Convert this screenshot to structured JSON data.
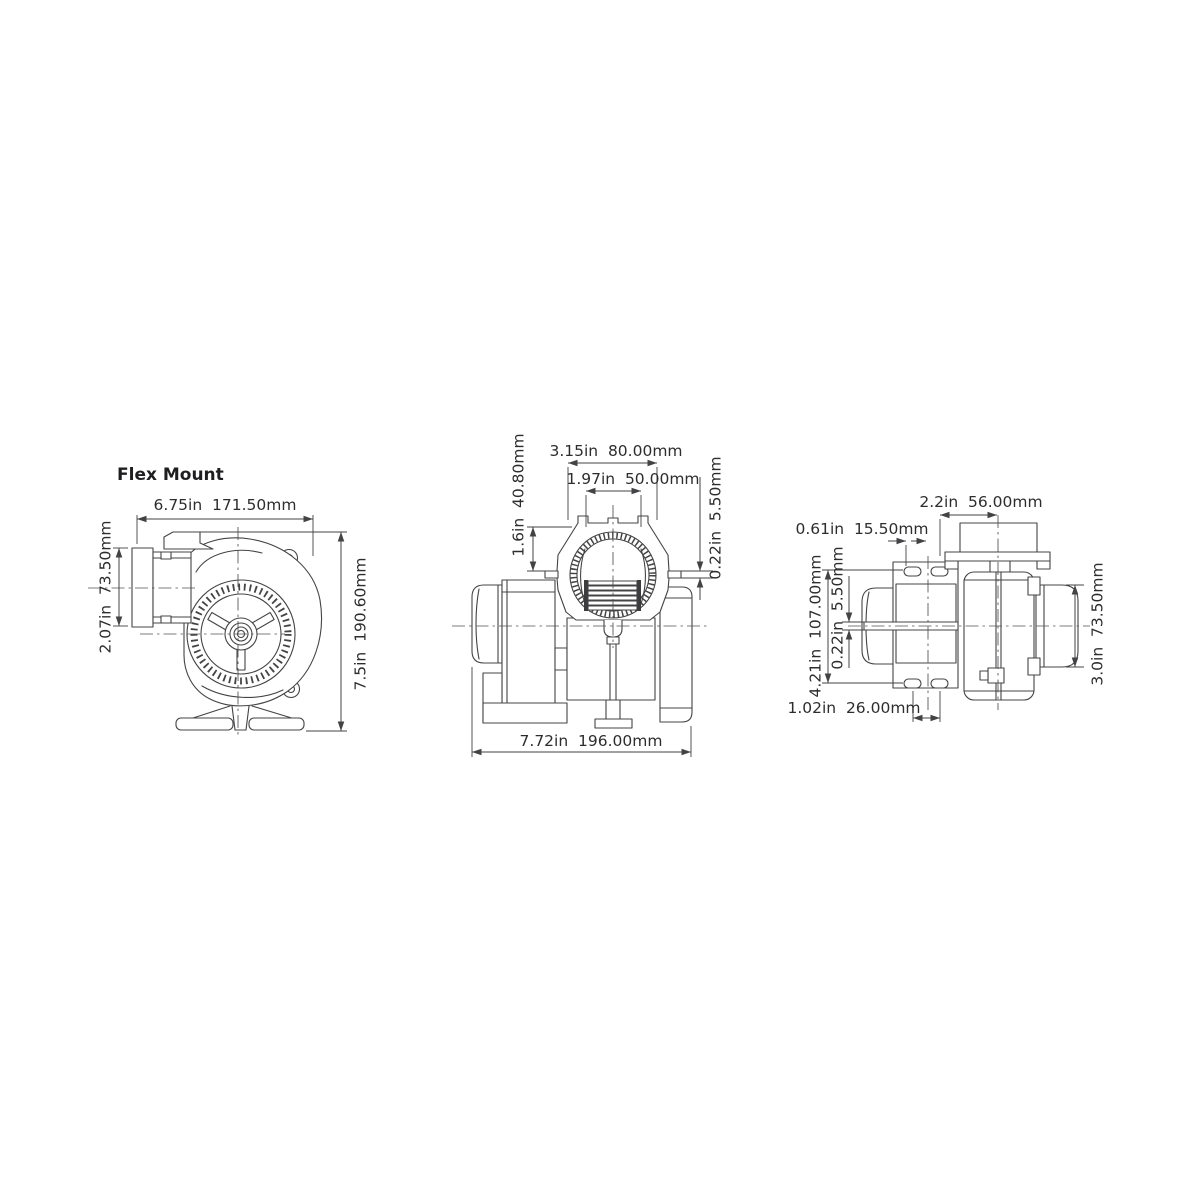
{
  "title": "Flex Mount",
  "colors": {
    "line": "#444446",
    "text": "#2d2d2f",
    "background": "#ffffff"
  },
  "side_view": {
    "width": "6.75in  171.50mm",
    "inlet_height": "2.07in  73.50mm",
    "overall_height": "7.5in  190.60mm"
  },
  "top_view": {
    "flange_width": "3.15in  80.00mm",
    "port_diameter": "1.97in  50.00mm",
    "flange_height": "1.6in  40.80mm",
    "lip_thickness": "0.22in  5.50mm",
    "overall_length": "7.72in  196.00mm"
  },
  "end_view": {
    "bracket_width": "2.2in  56.00mm",
    "slot_offset": "0.61in  15.50mm",
    "plate_height": "4.21in  107.00mm",
    "gap_thickness": "0.22in  5.50mm",
    "outlet_diameter": "3.0in  73.50mm",
    "slot_spacing": "1.02in  26.00mm"
  }
}
